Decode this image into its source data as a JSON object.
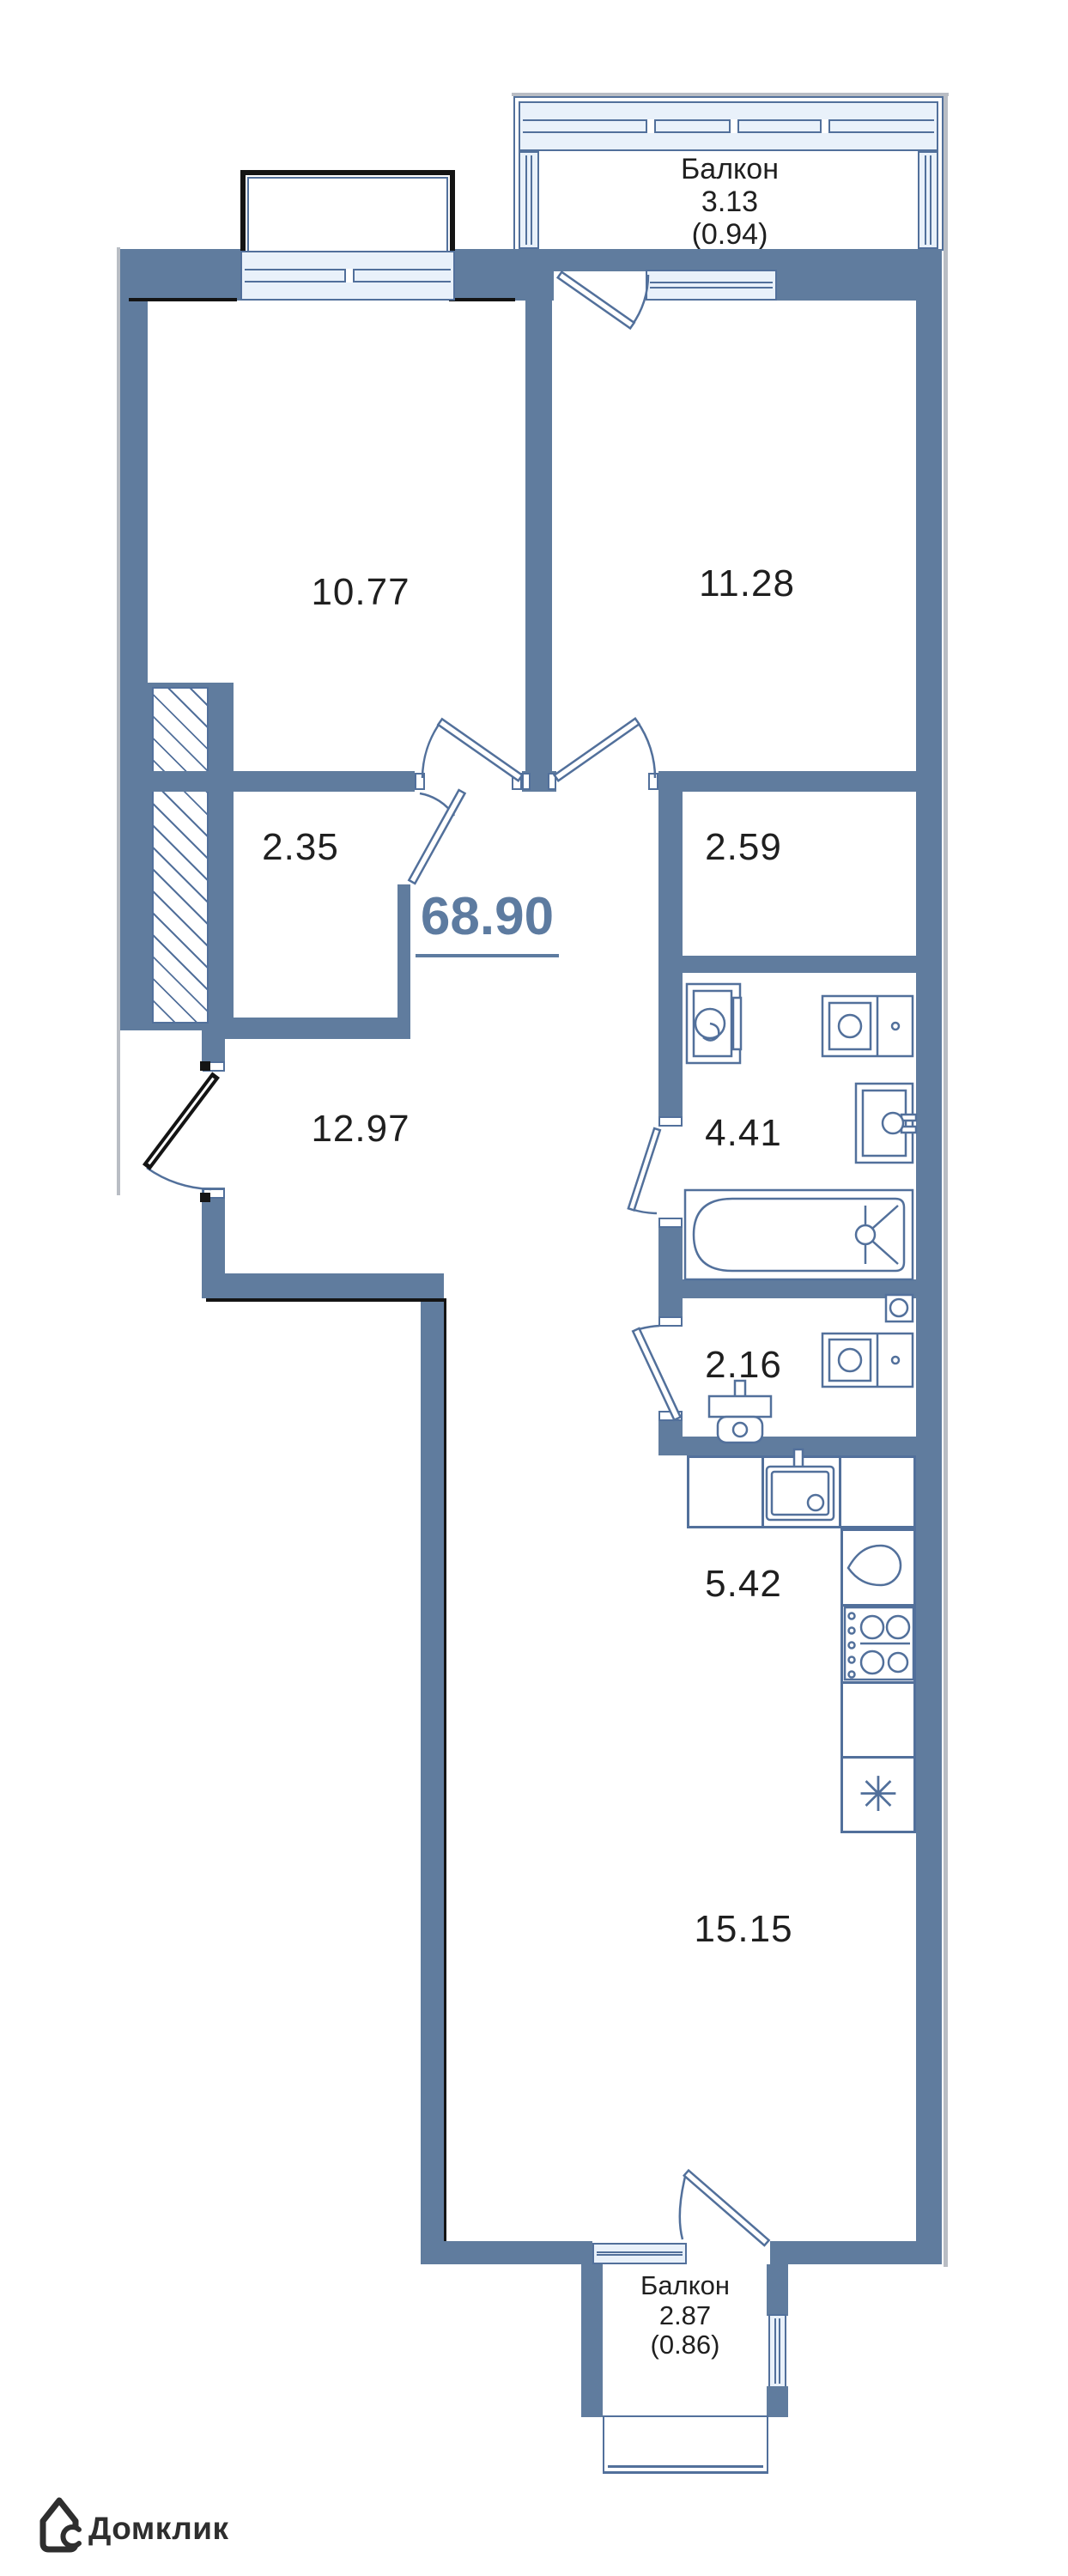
{
  "floorplan": {
    "total_area": "68.90",
    "rooms": [
      {
        "id": "room-top-left",
        "area": "10.77"
      },
      {
        "id": "room-top-right",
        "area": "11.28"
      },
      {
        "id": "closet",
        "area": "2.35"
      },
      {
        "id": "hall-nook",
        "area": "2.59"
      },
      {
        "id": "corridor",
        "area": "12.97"
      },
      {
        "id": "bathroom",
        "area": "4.41"
      },
      {
        "id": "wc",
        "area": "2.16"
      },
      {
        "id": "kitchen",
        "area": "5.42"
      },
      {
        "id": "living-room",
        "area": "15.15"
      }
    ],
    "balconies": [
      {
        "name": "Балкон",
        "area": "3.13",
        "coefficient_area": "(0.94)"
      },
      {
        "name": "Балкон",
        "area": "2.87",
        "coefficient_area": "(0.86)"
      }
    ]
  },
  "branding": {
    "logo": "Домклик"
  },
  "symbols": {
    "asterisk": "✳"
  },
  "icons": [
    "washing-machine-icon",
    "vanity-sink-icon",
    "water-heater-icon",
    "bathtub-icon",
    "toilet-icon",
    "vent-icon",
    "kitchen-sink-icon",
    "fridge-icon",
    "cooktop-icon",
    "asterisk-icon",
    "house-logo-icon"
  ],
  "colors": {
    "wall": "#607c9e",
    "line": "#52709b",
    "winfill": "#e9f1fa",
    "text": "#1f1f1f",
    "accent": "#5d7ba0",
    "black": "#141414",
    "logo": "#2e2e2e"
  }
}
